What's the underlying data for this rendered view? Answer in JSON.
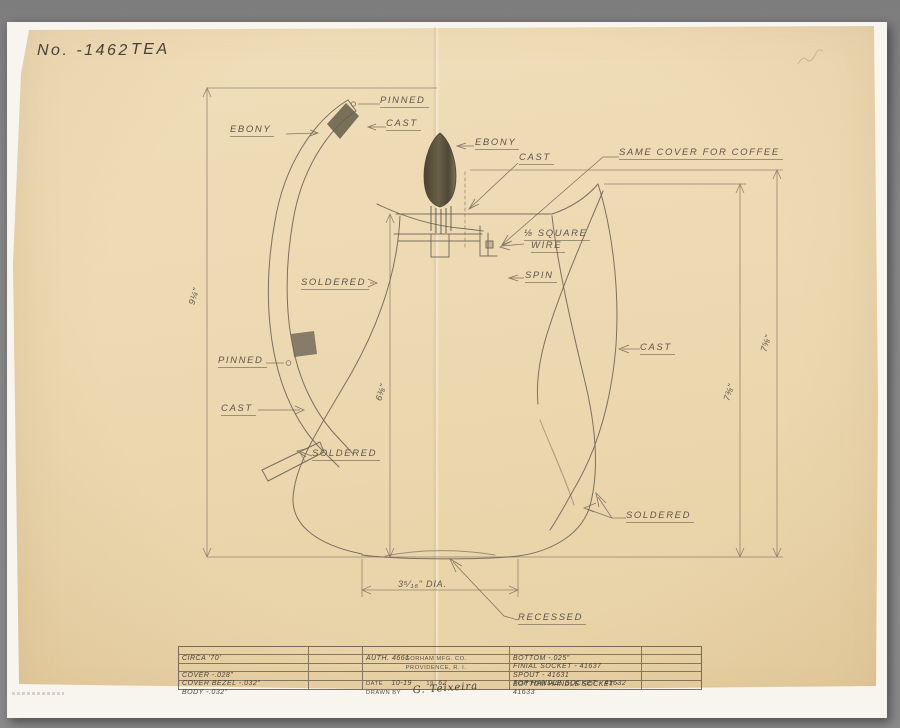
{
  "colors": {
    "surround": "#868686",
    "backing_sheet": "#f8f5ee",
    "paper": "#ecd8b0",
    "pencil": "#6e6557",
    "ebony_fill": "#56503e"
  },
  "header": {
    "number": "No. -1462",
    "name": "TEA"
  },
  "annotations": {
    "pinned_top": "PINNED",
    "cast_top": "CAST",
    "ebony_handle": "EBONY",
    "ebony_finial": "EBONY",
    "cast_cover": "CAST",
    "same_cover": "SAME COVER FOR COFFEE",
    "square_wire_line1": "⅛ SQUARE",
    "square_wire_line2": "WIRE",
    "spin": "SPIN",
    "soldered_upper": "SOLDERED",
    "pinned_mid": "PINNED",
    "cast_handle": "CAST",
    "soldered_handle": "SOLDERED",
    "cast_spout": "CAST",
    "soldered_spout": "SOLDERED",
    "recessed": "RECESSED",
    "diameter": "3⁵⁄₁₆\" DIA.",
    "dim_handle_height": "9¼\"",
    "dim_body_height": "6⅜\"",
    "dim_spout_height": "7⅜\"",
    "dim_overall_height": "7⅝\""
  },
  "title_block": {
    "left_rows": [
      "CIRCA '70'",
      "",
      "COVER -.028\"",
      "COVER BEZEL -.032\"",
      "BODY -.032\""
    ],
    "auth": "AUTH. 4661",
    "company": "GORHAM MFG. CO.",
    "city": "PROVIDENCE, R. I.",
    "date_label": "DATE",
    "date_value": "10-19",
    "year_prefix": "19",
    "year_value": "62",
    "drawn_by_label": "DRAWN BY",
    "signature": "G. Teixeira",
    "right_rows": [
      "BOTTOM -.025\"",
      "FINIAL SOCKET - 41637",
      "SPOUT - 41631",
      "TOP HANDLE SOCKET - 41632",
      "BOTTOM HANDLE SOCKET - 41633"
    ]
  }
}
